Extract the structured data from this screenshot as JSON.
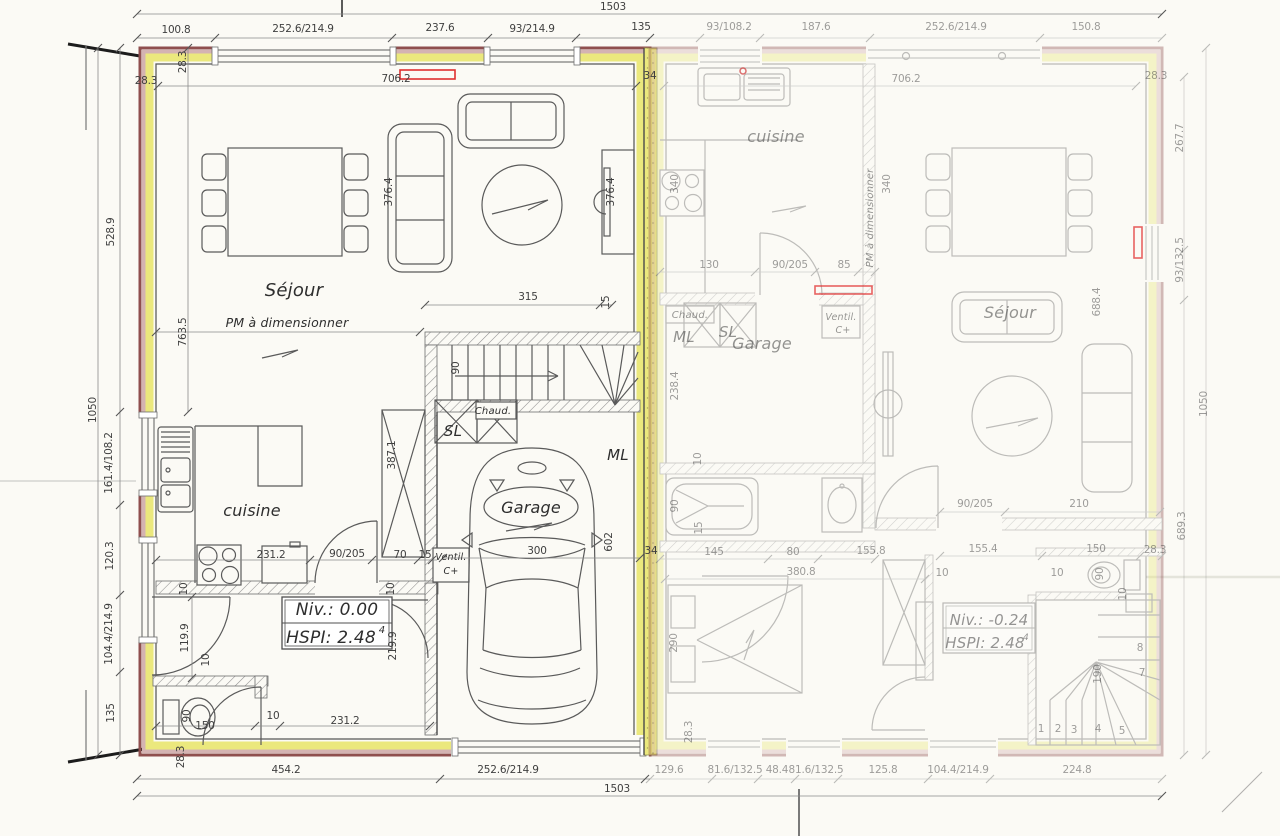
{
  "colors": {
    "paper": "#fbfaf5",
    "wall_outline": "#8f4f4e",
    "wall_band_pink": "#d4b3b2",
    "insulation_yellow": "#ebe87d",
    "line_dark": "#4a4a4a",
    "dim_line": "#8a8a8a",
    "text": "#3f3f3f",
    "highlight_red": "#e03030"
  },
  "labels": [
    {
      "t": "1503",
      "x": 613,
      "y": 10,
      "n": "dim-total-top"
    },
    {
      "t": "100.8",
      "x": 176,
      "y": 33
    },
    {
      "t": "252.6/214.9",
      "x": 303,
      "y": 32
    },
    {
      "t": "237.6",
      "x": 440,
      "y": 31
    },
    {
      "t": "93/214.9",
      "x": 532,
      "y": 32
    },
    {
      "t": "135",
      "x": 641,
      "y": 30
    },
    {
      "t": "28.3",
      "x": 146,
      "y": 84
    },
    {
      "t": "28.3",
      "x": 186,
      "y": 62,
      "r": -90
    },
    {
      "t": "706.2",
      "x": 396,
      "y": 82
    },
    {
      "t": "376.4",
      "x": 392,
      "y": 192,
      "r": -90
    },
    {
      "t": "376.4",
      "x": 614,
      "y": 192,
      "r": -90
    },
    {
      "t": "Séjour",
      "x": 294,
      "y": 296,
      "s": 18,
      "k": "hand",
      "n": "room-label-sejour-left"
    },
    {
      "t": "PM à dimensionner",
      "x": 287,
      "y": 327,
      "s": 12.5,
      "k": "hand",
      "n": "note-pm-left"
    },
    {
      "t": "315",
      "x": 528,
      "y": 300
    },
    {
      "t": "15",
      "x": 609,
      "y": 302,
      "r": -90
    },
    {
      "t": "763.5",
      "x": 186,
      "y": 332,
      "r": -90
    },
    {
      "t": "528.9",
      "x": 114,
      "y": 232,
      "r": -90
    },
    {
      "t": "1050",
      "x": 96,
      "y": 410,
      "r": -90
    },
    {
      "t": "90",
      "x": 459,
      "y": 368,
      "r": -90
    },
    {
      "t": "Chaud.",
      "x": 493,
      "y": 414,
      "s": 10,
      "k": "hand",
      "n": "room-label-chaud-left"
    },
    {
      "t": "SL",
      "x": 453,
      "y": 436,
      "s": 15,
      "k": "hand",
      "n": "room-label-sl-left"
    },
    {
      "t": "ML",
      "x": 618,
      "y": 460,
      "s": 15,
      "k": "hand",
      "n": "room-label-ml-left"
    },
    {
      "t": "387.1",
      "x": 395,
      "y": 455,
      "r": -90
    },
    {
      "t": "cuisine",
      "x": 252,
      "y": 516,
      "s": 16,
      "k": "hand",
      "n": "room-label-cuisine-left"
    },
    {
      "t": "161.4/108.2",
      "x": 112,
      "y": 463,
      "r": -90
    },
    {
      "t": "120.3",
      "x": 113,
      "y": 556,
      "r": -90
    },
    {
      "t": "104.4/214.9",
      "x": 112,
      "y": 634,
      "r": -90
    },
    {
      "t": "135",
      "x": 114,
      "y": 713,
      "r": -90
    },
    {
      "t": "231.2",
      "x": 271,
      "y": 558
    },
    {
      "t": "90/205",
      "x": 347,
      "y": 557
    },
    {
      "t": "70",
      "x": 400,
      "y": 558
    },
    {
      "t": "15",
      "x": 425,
      "y": 558
    },
    {
      "t": "Ventil.",
      "x": 451,
      "y": 560,
      "s": 9.5,
      "k": "hand",
      "n": "room-label-ventil-left"
    },
    {
      "t": "C+",
      "x": 451,
      "y": 574,
      "s": 9.5,
      "k": "hand"
    },
    {
      "t": "Garage",
      "x": 531,
      "y": 513,
      "s": 16,
      "k": "hand",
      "n": "room-label-garage-left"
    },
    {
      "t": "300",
      "x": 537,
      "y": 554
    },
    {
      "t": "602",
      "x": 612,
      "y": 542,
      "r": -90
    },
    {
      "t": "34",
      "x": 651,
      "y": 554
    },
    {
      "t": "34",
      "x": 650,
      "y": 79
    },
    {
      "t": "119.9",
      "x": 188,
      "y": 638,
      "r": -90
    },
    {
      "t": "10",
      "x": 209,
      "y": 660,
      "r": -90
    },
    {
      "t": "10",
      "x": 187,
      "y": 589,
      "r": -90
    },
    {
      "t": "10",
      "x": 394,
      "y": 589,
      "r": -90
    },
    {
      "t": "Niv.: 0.00",
      "x": 337,
      "y": 615,
      "s": 17,
      "k": "hand",
      "n": "level-label-left"
    },
    {
      "t": "HSPI: 2.48",
      "x": 331,
      "y": 643,
      "s": 17,
      "k": "hand",
      "n": "hspi-label-left"
    },
    {
      "t": "4",
      "x": 382,
      "y": 633,
      "s": 10,
      "k": "hand"
    },
    {
      "t": "219.9",
      "x": 396,
      "y": 646,
      "r": -90
    },
    {
      "t": "90",
      "x": 190,
      "y": 716,
      "r": -90
    },
    {
      "t": "150",
      "x": 205,
      "y": 729
    },
    {
      "t": "10",
      "x": 273,
      "y": 719
    },
    {
      "t": "231.2",
      "x": 345,
      "y": 724
    },
    {
      "t": "28.3",
      "x": 184,
      "y": 757,
      "r": -90
    },
    {
      "t": "454.2",
      "x": 286,
      "y": 773
    },
    {
      "t": "252.6/214.9",
      "x": 508,
      "y": 773
    },
    {
      "t": "1503",
      "x": 617,
      "y": 792,
      "n": "dim-total-bottom"
    },
    {
      "t": "93/108.2",
      "x": 729,
      "y": 30,
      "o": "fd"
    },
    {
      "t": "187.6",
      "x": 816,
      "y": 30,
      "o": "fd"
    },
    {
      "t": "252.6/214.9",
      "x": 956,
      "y": 30,
      "o": "fd"
    },
    {
      "t": "150.8",
      "x": 1086,
      "y": 30,
      "o": "fd"
    },
    {
      "t": "28.3",
      "x": 1156,
      "y": 79,
      "o": "fd"
    },
    {
      "t": "706.2",
      "x": 906,
      "y": 82,
      "o": "fd"
    },
    {
      "t": "cuisine",
      "x": 776,
      "y": 142,
      "s": 16,
      "k": "hand",
      "o": "fd",
      "n": "room-label-cuisine-right"
    },
    {
      "t": "340",
      "x": 678,
      "y": 184,
      "r": -90,
      "o": "fd"
    },
    {
      "t": "PM à dimensionner",
      "x": 873,
      "y": 218,
      "r": -90,
      "s": 10,
      "k": "hand",
      "o": "fd",
      "n": "note-pm-right"
    },
    {
      "t": "340",
      "x": 890,
      "y": 184,
      "r": -90,
      "o": "fd"
    },
    {
      "t": "267.7",
      "x": 1183,
      "y": 138,
      "r": -90,
      "o": "fd"
    },
    {
      "t": "93/132.5",
      "x": 1183,
      "y": 260,
      "r": -90,
      "o": "fd"
    },
    {
      "t": "1050",
      "x": 1207,
      "y": 404,
      "r": -90,
      "o": "fd"
    },
    {
      "t": "130",
      "x": 709,
      "y": 268,
      "o": "fd"
    },
    {
      "t": "90/205",
      "x": 790,
      "y": 268,
      "o": "fd"
    },
    {
      "t": "85",
      "x": 844,
      "y": 268,
      "o": "fd"
    },
    {
      "t": "Chaud.",
      "x": 690,
      "y": 318,
      "s": 10,
      "k": "hand",
      "o": "fd",
      "n": "room-label-chaud-right"
    },
    {
      "t": "ML",
      "x": 684,
      "y": 342,
      "s": 15,
      "k": "hand",
      "o": "fd",
      "n": "room-label-ml-right"
    },
    {
      "t": "SL",
      "x": 728,
      "y": 337,
      "s": 15,
      "k": "hand",
      "o": "fd",
      "n": "room-label-sl-right"
    },
    {
      "t": "Garage",
      "x": 762,
      "y": 349,
      "s": 16,
      "k": "hand",
      "o": "fd",
      "n": "room-label-garage-right"
    },
    {
      "t": "Ventil.",
      "x": 841,
      "y": 320,
      "s": 9.5,
      "k": "hand",
      "o": "fd",
      "n": "room-label-ventil-right"
    },
    {
      "t": "C+",
      "x": 843,
      "y": 333,
      "s": 9.5,
      "k": "hand",
      "o": "fd"
    },
    {
      "t": "238.4",
      "x": 678,
      "y": 386,
      "r": -90,
      "o": "fd"
    },
    {
      "t": "10",
      "x": 701,
      "y": 459,
      "r": -90,
      "o": "fd"
    },
    {
      "t": "Séjour",
      "x": 1010,
      "y": 318,
      "s": 16,
      "k": "hand",
      "o": "fd",
      "n": "room-label-sejour-right"
    },
    {
      "t": "688.4",
      "x": 1100,
      "y": 302,
      "r": -90,
      "o": "fd"
    },
    {
      "t": "90",
      "x": 678,
      "y": 506,
      "r": -90,
      "o": "fd"
    },
    {
      "t": "15",
      "x": 702,
      "y": 528,
      "r": -90,
      "o": "fd"
    },
    {
      "t": "145",
      "x": 714,
      "y": 555,
      "o": "fd"
    },
    {
      "t": "80",
      "x": 793,
      "y": 555,
      "o": "fd"
    },
    {
      "t": "155.8",
      "x": 871,
      "y": 554,
      "o": "fd"
    },
    {
      "t": "380.8",
      "x": 801,
      "y": 575,
      "o": "fd"
    },
    {
      "t": "10",
      "x": 942,
      "y": 576,
      "o": "fd"
    },
    {
      "t": "90/205",
      "x": 975,
      "y": 507,
      "o": "fd"
    },
    {
      "t": "210",
      "x": 1079,
      "y": 507,
      "o": "fd"
    },
    {
      "t": "689.3",
      "x": 1185,
      "y": 526,
      "r": -90,
      "o": "fd"
    },
    {
      "t": "28.3",
      "x": 1155,
      "y": 553,
      "o": "fd"
    },
    {
      "t": "155.4",
      "x": 983,
      "y": 552,
      "o": "fd"
    },
    {
      "t": "150",
      "x": 1096,
      "y": 552,
      "o": "fd"
    },
    {
      "t": "10",
      "x": 1057,
      "y": 576,
      "o": "fd"
    },
    {
      "t": "90",
      "x": 1103,
      "y": 574,
      "r": -90,
      "o": "fd"
    },
    {
      "t": "10",
      "x": 1126,
      "y": 594,
      "r": -90,
      "o": "fd"
    },
    {
      "t": "290",
      "x": 677,
      "y": 643,
      "r": -90,
      "o": "fd"
    },
    {
      "t": "Niv.: -0.24",
      "x": 989,
      "y": 625,
      "s": 15,
      "k": "hand",
      "o": "fd",
      "n": "level-label-right"
    },
    {
      "t": "HSPI: 2.48",
      "x": 985,
      "y": 648,
      "s": 15,
      "k": "hand",
      "o": "fd",
      "n": "hspi-label-right"
    },
    {
      "t": "4",
      "x": 1026,
      "y": 640,
      "s": 9,
      "k": "hand",
      "o": "fd"
    },
    {
      "t": "190",
      "x": 1101,
      "y": 674,
      "r": -90,
      "o": "fd"
    },
    {
      "t": "8",
      "x": 1140,
      "y": 651,
      "o": "fd"
    },
    {
      "t": "7",
      "x": 1142,
      "y": 676,
      "o": "fd"
    },
    {
      "t": "1",
      "x": 1041,
      "y": 732,
      "o": "fd"
    },
    {
      "t": "2",
      "x": 1058,
      "y": 732,
      "o": "fd"
    },
    {
      "t": "3",
      "x": 1074,
      "y": 733,
      "o": "fd"
    },
    {
      "t": "4",
      "x": 1098,
      "y": 732,
      "o": "fd"
    },
    {
      "t": "5",
      "x": 1122,
      "y": 734,
      "o": "fd"
    },
    {
      "t": "28.3",
      "x": 692,
      "y": 732,
      "r": -90,
      "o": "fd"
    },
    {
      "t": "129.6",
      "x": 669,
      "y": 773,
      "o": "fd"
    },
    {
      "t": "81.6/132.5",
      "x": 735,
      "y": 773,
      "o": "fd"
    },
    {
      "t": "48.4",
      "x": 777,
      "y": 773,
      "o": "fd"
    },
    {
      "t": "81.6/132.5",
      "x": 816,
      "y": 773,
      "o": "fd"
    },
    {
      "t": "125.8",
      "x": 883,
      "y": 773,
      "o": "fd"
    },
    {
      "t": "104.4/214.9",
      "x": 958,
      "y": 773,
      "o": "fd"
    },
    {
      "t": "224.8",
      "x": 1077,
      "y": 773,
      "o": "fd"
    }
  ]
}
